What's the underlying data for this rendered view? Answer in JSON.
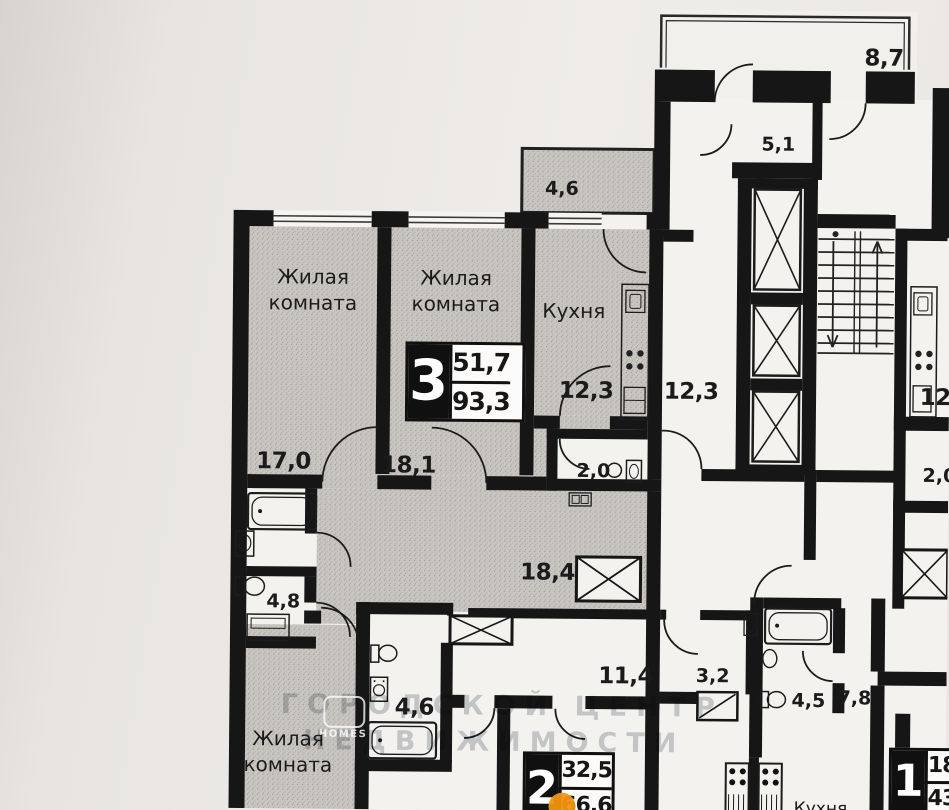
{
  "apt3": {
    "number": "3",
    "area_living": "51,7",
    "area_total": "93,3",
    "room1_name": "Жилая комната",
    "room1_area": "17,0",
    "room2_name": "Жилая комната",
    "room2_area": "18,1",
    "room3_name": "Жилая комната",
    "kitchen_name": "Кухня",
    "kitchen_area": "12,3",
    "balcony_area": "4,6",
    "wc_area": "2,0",
    "hall_area": "18,4",
    "bath_small_area": "4,8",
    "bathroom_area": "4,6"
  },
  "apt2": {
    "number": "2",
    "area_living": "32,5",
    "area_total": "66,6",
    "hall_area": "11,4",
    "storage_area": "3,2",
    "bathroom_area": "4,5"
  },
  "apt1": {
    "number": "1",
    "area_living": "18",
    "area_total": "43",
    "hall_area": "7,8",
    "kitchen_name": "Кухня"
  },
  "common": {
    "lift_hall_area": "5,1",
    "balcony_area": "8,7",
    "corridor_area": "12,3",
    "right_kitchen_area": "12,3",
    "right_wc_area": "2,0"
  },
  "watermark": {
    "line1": "ГОРОДСКОЙ ЦЕНТР",
    "line2": "НЕДВИЖИМОСТИ",
    "logo": "HOMES"
  },
  "colors": {
    "wall": "#161616",
    "paper": "#e9e6e3",
    "room_fill": "#c9c6c2",
    "marker_orange": "#f2930f"
  }
}
